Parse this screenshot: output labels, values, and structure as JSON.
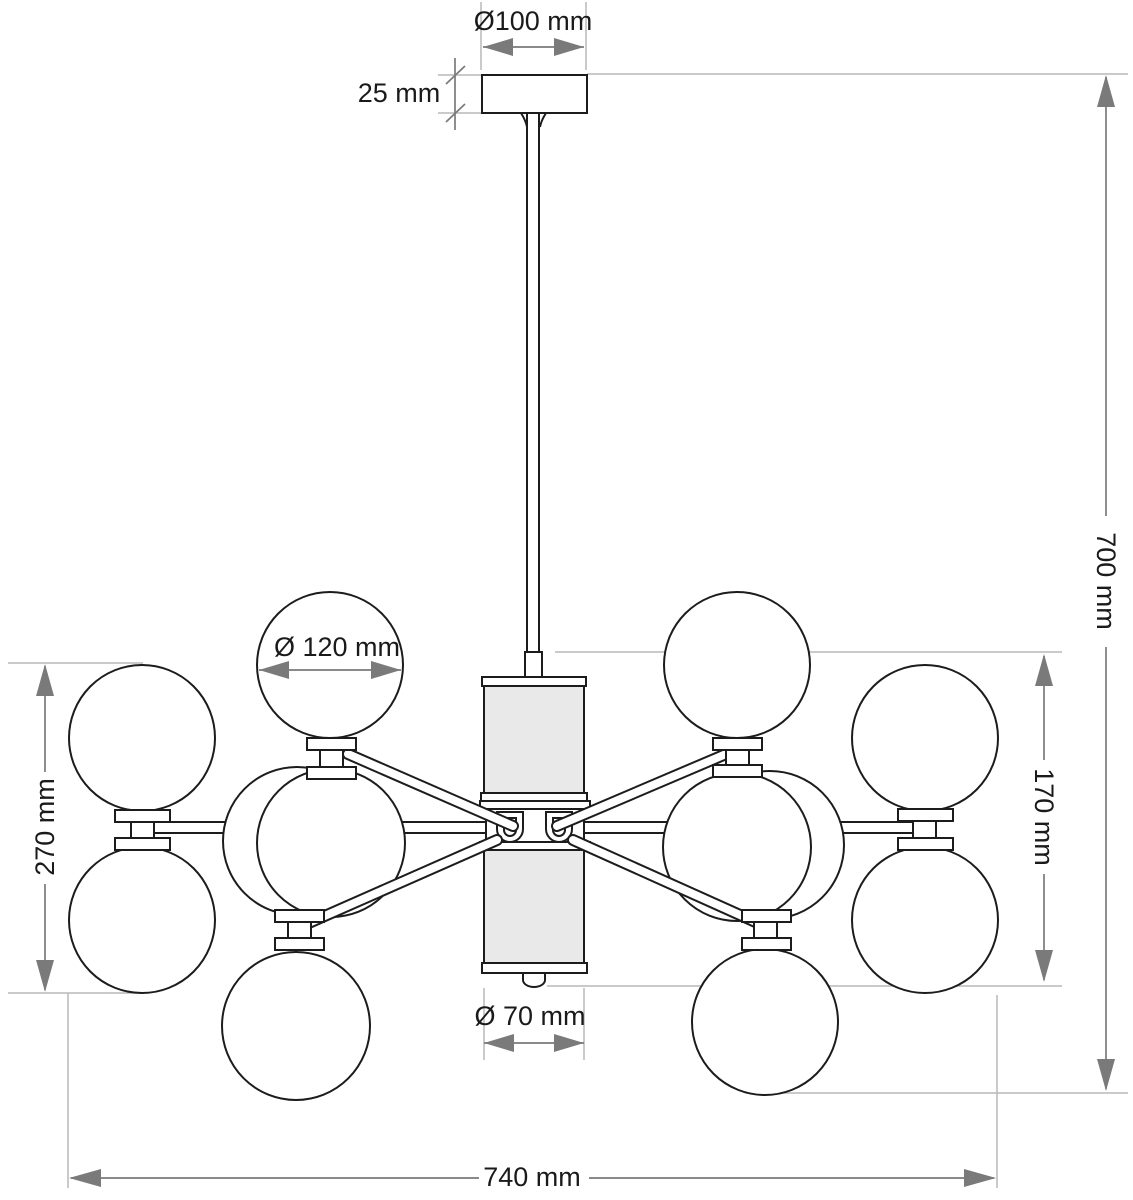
{
  "drawing": {
    "kind": "technical dimension drawing — chandelier side elevation, 12 globe shades",
    "labels": {
      "canopy_diameter": "Ø100 mm",
      "canopy_height": "25 mm",
      "overall_height": "700 mm",
      "globe_diameter": "Ø 120 mm",
      "outer_pair_height": "270 mm",
      "center_column_height": "170 mm",
      "column_diameter": "Ø 70 mm",
      "overall_width": "740 mm"
    },
    "colors": {
      "background": "#ffffff",
      "outline": "#1c1c1c",
      "dimension_line": "#7a7a7a",
      "extension_line": "#b9b9b9",
      "shade_fill": "#e9e9e9",
      "label_text": "#1a1a1a"
    }
  }
}
